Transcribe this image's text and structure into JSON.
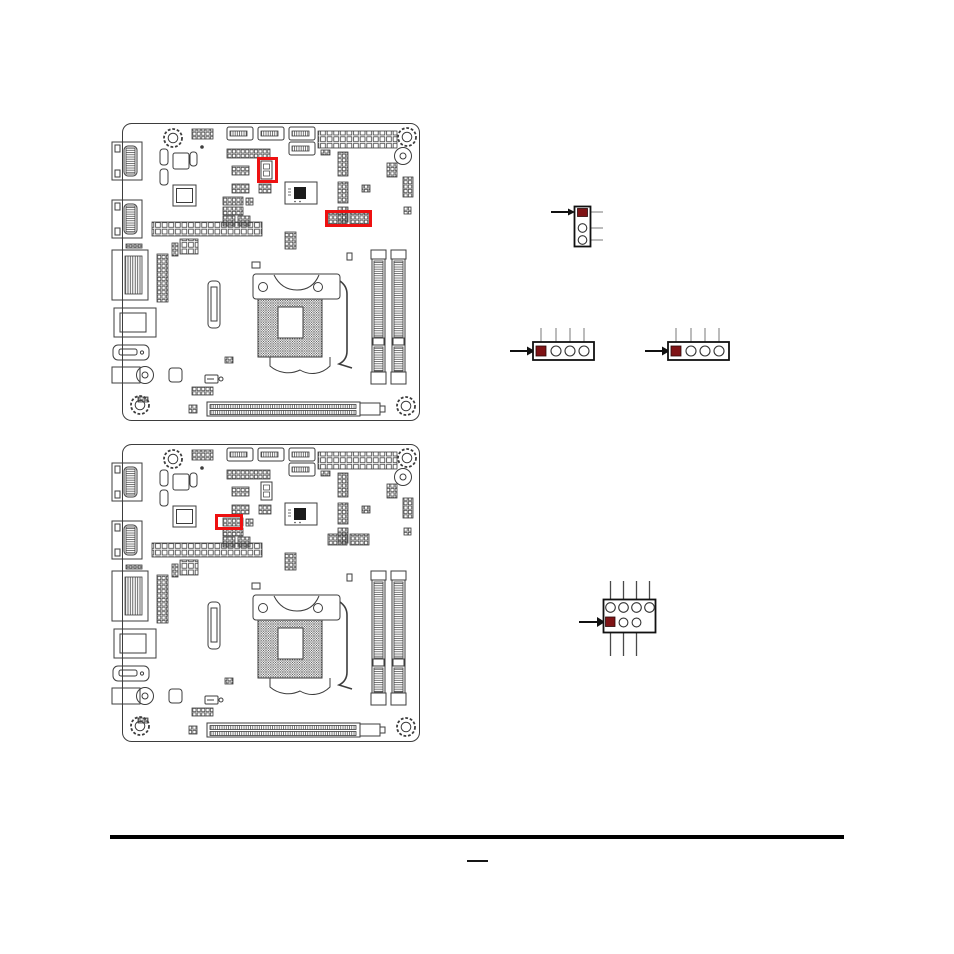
{
  "page": {
    "background": "#ffffff",
    "kind": "motherboard manual page"
  },
  "colors": {
    "board_line": "#3d3d3d",
    "highlight_box": "#ee1111",
    "pin1_fill": "#7f1315",
    "stub_line": "#8f8f8f",
    "arrow": "#111111",
    "footer_rule": "#000000"
  },
  "figures": {
    "board_top": {
      "label": "Motherboard layout diagram (upper figure) with two red highlight boxes",
      "highlights": 2
    },
    "board_bottom": {
      "label": "Motherboard layout diagram (lower figure) with one red highlight box",
      "highlights": 1
    },
    "header_3pin": {
      "label": "3-pin vertical jumper header, pin 1 shown as dark red square, arrow pointing to pin 1",
      "pins": 3,
      "orientation": "vertical"
    },
    "header_4pin_left": {
      "label": "4-pin horizontal header, pin 1 shown as dark red square, arrow pointing to pin 1",
      "pins": 4,
      "orientation": "horizontal"
    },
    "header_4pin_right": {
      "label": "4-pin horizontal header, pin 1 shown as dark red square, arrow pointing to pin 1",
      "pins": 4,
      "orientation": "horizontal"
    },
    "header_2x4": {
      "label": "2x4 pin header, pin 1 shown as dark red square in lower-left, arrow pointing to pin 1",
      "pins": 7,
      "orientation": "2x4 grid"
    }
  },
  "footer": {
    "rule": true,
    "page_dash": "—"
  }
}
